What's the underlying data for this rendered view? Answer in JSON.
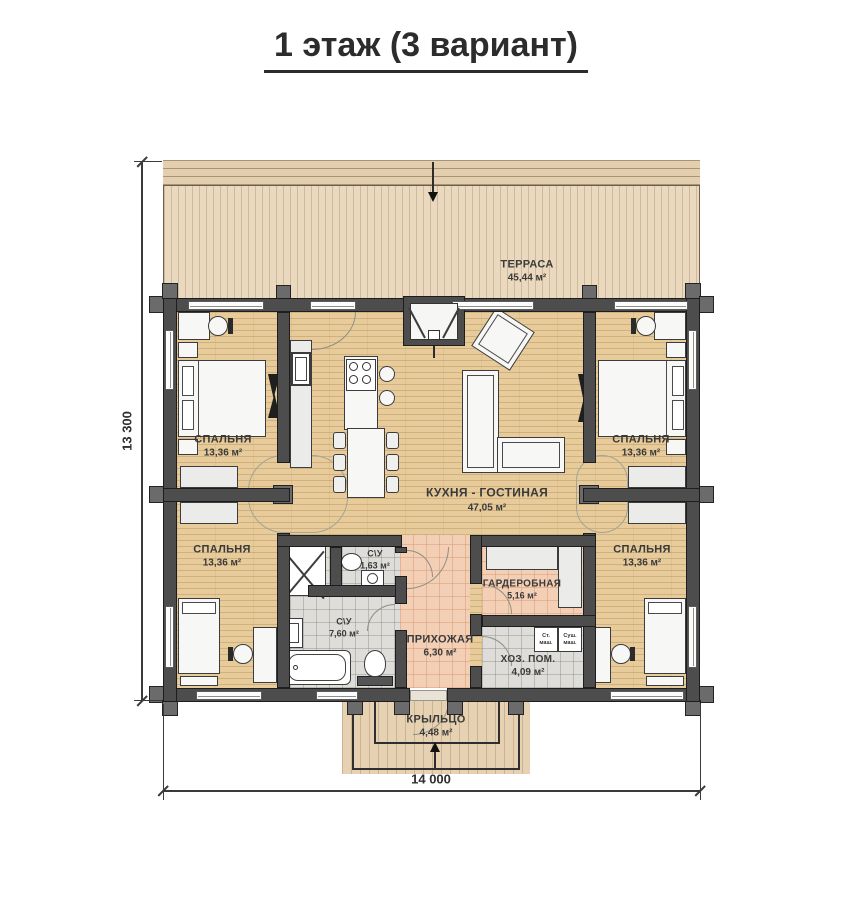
{
  "title": "1 этаж (3 вариант)",
  "dimensions": {
    "horizontal": "14 000",
    "vertical": "13 300"
  },
  "rooms": {
    "terrace": {
      "name": "ТЕРРАСА",
      "area": "45,44 м²"
    },
    "bedroom_top_left": {
      "name": "СПАЛЬНЯ",
      "area": "13,36 м²"
    },
    "bedroom_top_right": {
      "name": "СПАЛЬНЯ",
      "area": "13,36 м²"
    },
    "bedroom_bottom_left": {
      "name": "СПАЛЬНЯ",
      "area": "13,36 м²"
    },
    "bedroom_bottom_right": {
      "name": "СПАЛЬНЯ",
      "area": "13,36 м²"
    },
    "kitchen_living": {
      "name": "КУХНЯ - ГОСТИНАЯ",
      "area": "47,05 м²"
    },
    "wc_small": {
      "name": "С\\У",
      "area": "1,63 м²"
    },
    "bathroom": {
      "name": "С\\У",
      "area": "7,60 м²"
    },
    "hallway": {
      "name": "ПРИХОЖАЯ",
      "area": "6,30 м²"
    },
    "wardrobe": {
      "name": "ГАРДЕРОБНАЯ",
      "area": "5,16 м²"
    },
    "utility": {
      "name": "ХОЗ. ПОМ.",
      "area": "4,09 м²"
    },
    "porch": {
      "name": "КРЫЛЬЦО",
      "area": "4,48 м²"
    }
  },
  "appliances": {
    "washer_line1": "Ст.",
    "washer_line2": "маш.",
    "dryer_line1": "Суш.",
    "dryer_line2": "маш."
  },
  "colors": {
    "wall": "#4d4d4d",
    "wood_floor": "#e7cb9a",
    "deck": "#ead9bf",
    "tile_gray": "#dedddа",
    "tile_salmon": "#f3cfb6"
  }
}
